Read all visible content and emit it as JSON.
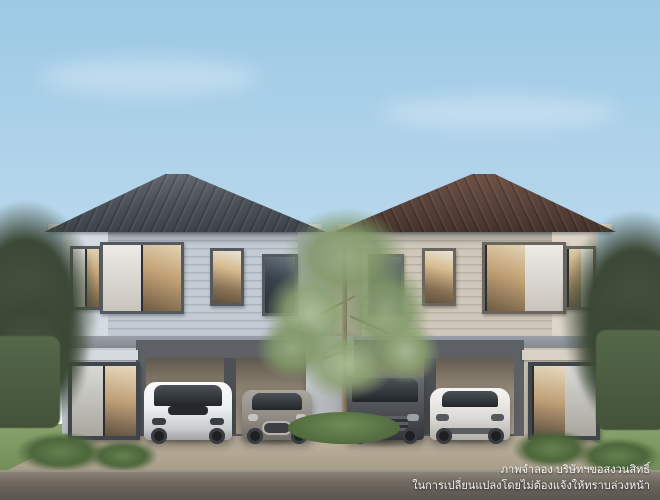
{
  "disclaimer": {
    "line1": "ภาพจำลอง บริษัทฯขอสงวนสิทธิ์",
    "line2": "ในการเปลี่ยนแปลงโดยไม่ต้องแจ้งให้ทราบล่วงหน้า"
  },
  "palette": {
    "sky_top": "#9cc9e5",
    "sky_mid": "#b9d8ec",
    "sky_horizon": "#e3eff6",
    "left_roof": "#4b5058",
    "right_roof": "#57413a",
    "fascia_left": "#dde1e6",
    "fascia_right": "#e2dcd1",
    "left_siding": "#c2cad3",
    "left_panel": "#d5dbe2",
    "left_recess": "#a9b1ba",
    "right_siding": "#cfc8ba",
    "right_panel": "#dcd5c8",
    "right_recess": "#b2a99a",
    "floor_band": "#84898f",
    "garage_frame": "#5d6166",
    "garage_interior": "#978b79",
    "window_frame": "#555a61",
    "pillar": "#9fa3a6",
    "grass": "#8aa36c",
    "driveway": "#b2a692",
    "road": "#8b8478",
    "hedge": "#435239",
    "edge_tree": "#475440",
    "tree_trunk": "#6f6150",
    "text": "#f6f6f6"
  }
}
